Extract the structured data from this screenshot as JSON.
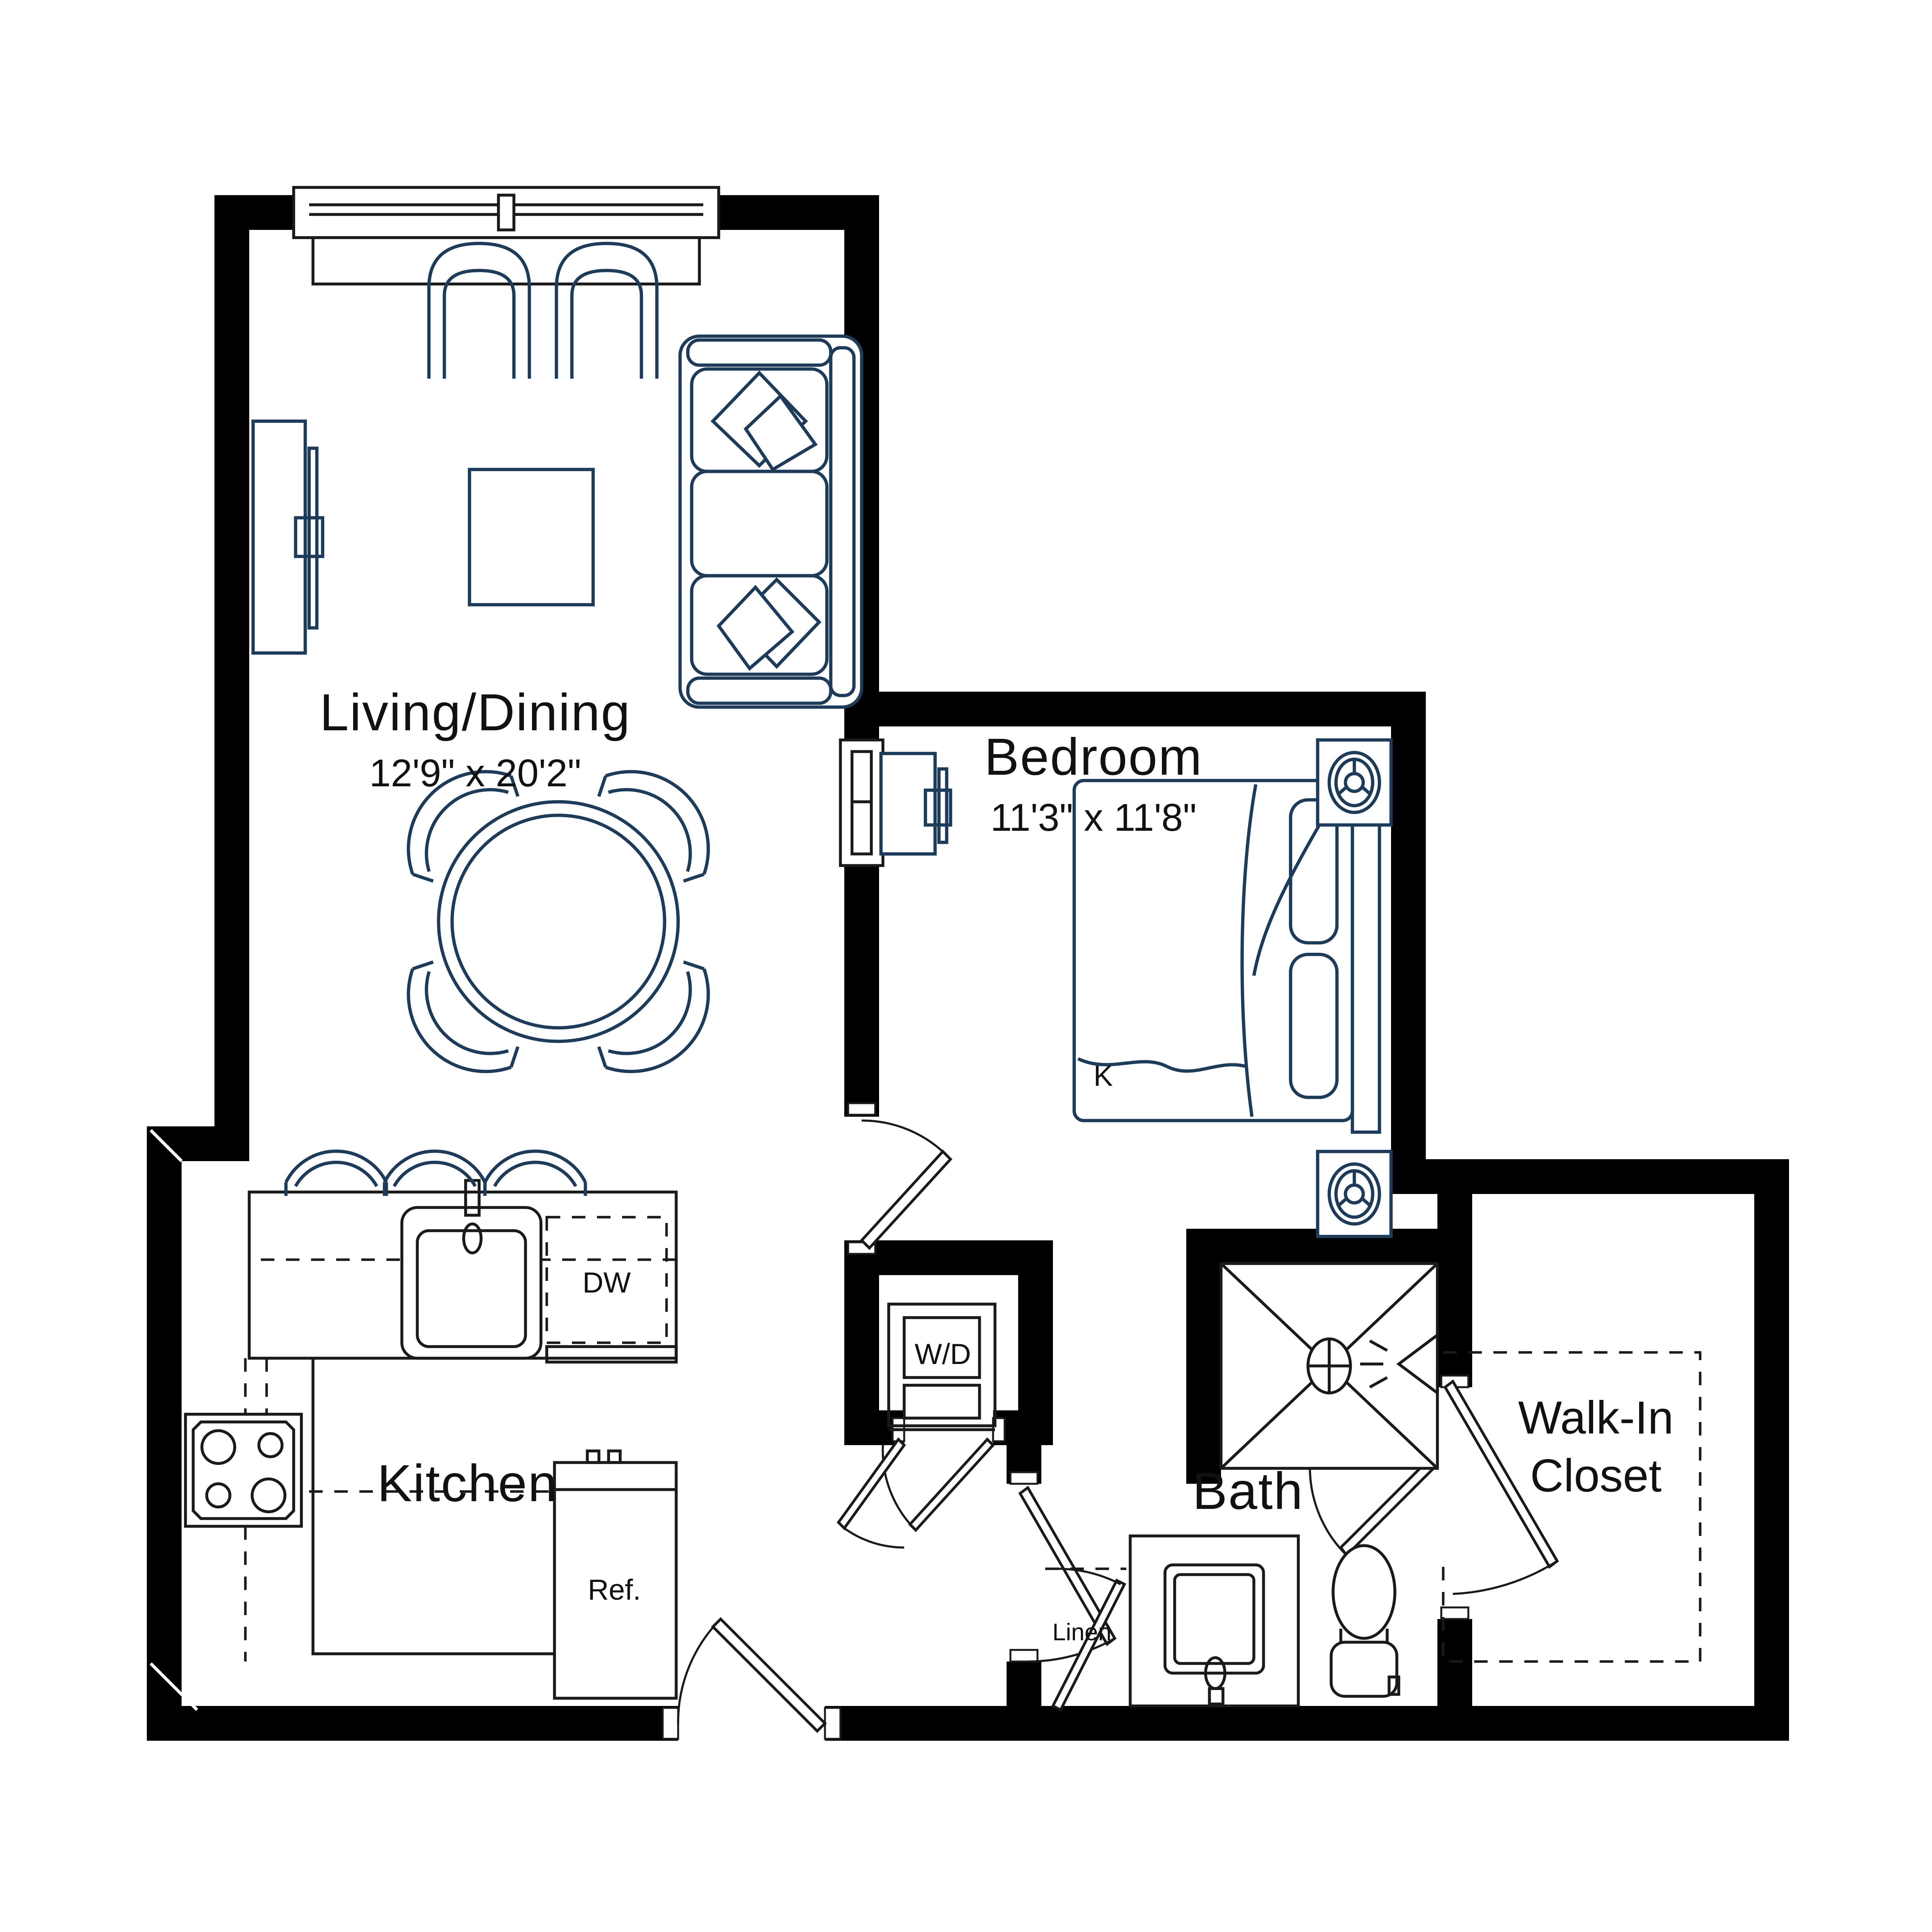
{
  "page": {
    "background": "#ffffff"
  },
  "colors": {
    "wall": "#000000",
    "fixture_line": "#1a1a1a",
    "furniture_line": "#1e3c5a",
    "label_text": "#111111"
  },
  "rooms": {
    "living_dining": {
      "name": "Living/Dining",
      "dimensions": "12'9\" x 20'2\""
    },
    "bedroom": {
      "name": "Bedroom",
      "dimensions": "11'3\" x 11'8\""
    },
    "kitchen": {
      "name": "Kitchen"
    },
    "bath": {
      "name": "Bath"
    },
    "walk_in_closet": {
      "line1": "Walk-In",
      "line2": "Closet"
    },
    "linen": {
      "name": "Linen"
    }
  },
  "appliances": {
    "dishwasher": "DW",
    "washer_dryer": "W/D",
    "refrigerator": "Ref."
  },
  "bed": {
    "size_label": "K"
  }
}
